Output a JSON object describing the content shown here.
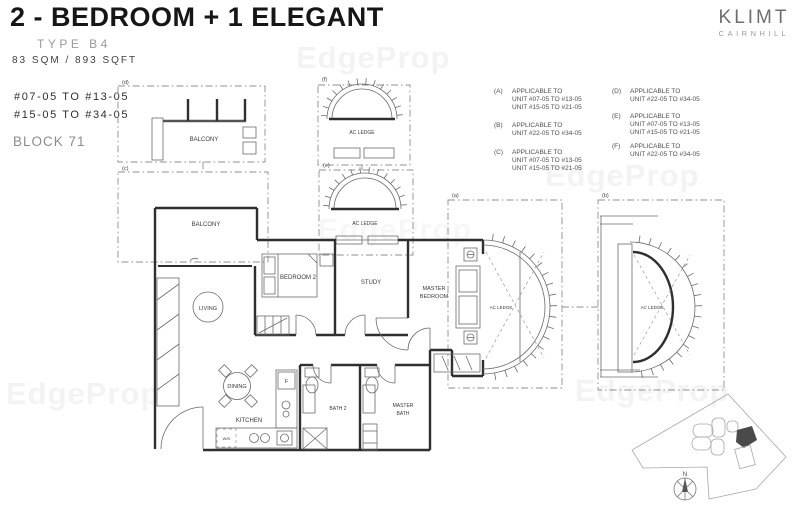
{
  "header": {
    "title": "2 - BEDROOM + 1 ELEGANT",
    "type": "TYPE B4",
    "area": "83 SQM / 893 SQFT",
    "units_line1": "#07-05 TO #13-05",
    "units_line2": "#15-05 TO #34-05",
    "block": "BLOCK 71"
  },
  "brand": {
    "name": "KLIMT",
    "subtitle": "CAIRNHILL"
  },
  "legend": {
    "items": [
      {
        "key": "(A)",
        "lines": [
          "APPLICABLE TO",
          "UNIT #07-05 TO #13-05",
          "UNIT #15-05 TO #21-05"
        ]
      },
      {
        "key": "(B)",
        "lines": [
          "APPLICABLE TO",
          "UNIT #22-05 TO #34-05"
        ]
      },
      {
        "key": "(C)",
        "lines": [
          "APPLICABLE TO",
          "UNIT #07-05 TO #13-05",
          "UNIT #15-05 TO #21-05"
        ]
      },
      {
        "key": "(D)",
        "lines": [
          "APPLICABLE TO",
          "UNIT #22-05 TO #34-05"
        ]
      },
      {
        "key": "(E)",
        "lines": [
          "APPLICABLE TO",
          "UNIT #07-05 TO #13-05",
          "UNIT #15-05 TO #21-05"
        ]
      },
      {
        "key": "(F)",
        "lines": [
          "APPLICABLE TO",
          "UNIT #22-05 TO #34-05"
        ]
      }
    ]
  },
  "plan": {
    "markers": {
      "a": "(a)",
      "b": "(b)",
      "c": "(c)",
      "d": "(d)",
      "e": "(e)",
      "f": "(f)"
    },
    "rooms": {
      "balcony_upper": "BALCONY",
      "balcony": "BALCONY",
      "living": "LIVING",
      "bedroom2": "BEDROOM 2",
      "study": "STUDY",
      "master_line1": "MASTER",
      "master_line2": "BEDROOM",
      "dining": "DINING",
      "kitchen": "KITCHEN",
      "bath2": "BATH 2",
      "master_bath_line1": "MASTER",
      "master_bath_line2": "BATH",
      "ac_ledge": "AC LEDGE",
      "washer_dryer": "W/D",
      "fridge": "F"
    },
    "compass": "N"
  },
  "watermark": "EdgeProp",
  "colors": {
    "wall": "#2f2f2f",
    "dashed": "#8f8f8f",
    "brand_gray": "#6e6e6e"
  }
}
